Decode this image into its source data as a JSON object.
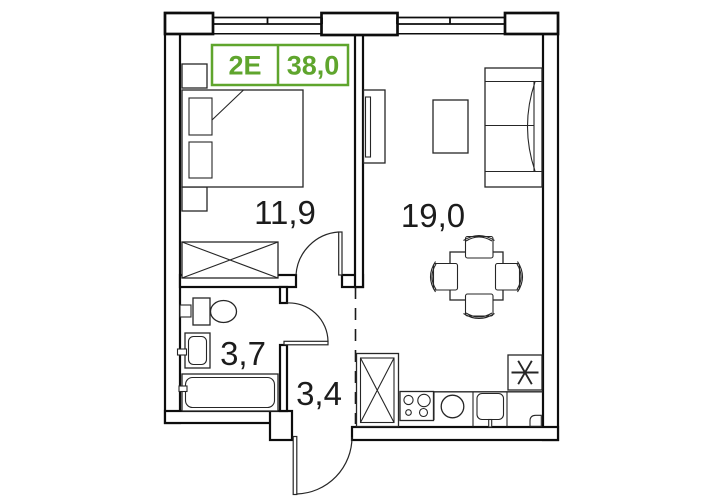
{
  "unit_badge": {
    "type": "2E",
    "area": "38,0"
  },
  "rooms": {
    "bedroom": {
      "area": "11,9"
    },
    "living_kitchen": {
      "area": "19,0"
    },
    "bathroom": {
      "area": "3,7"
    },
    "hallway": {
      "area": "3,4"
    }
  },
  "colors": {
    "accent": "#5fa52d",
    "line": "#262626",
    "wall": "#0d0d0d",
    "background": "#ffffff"
  }
}
